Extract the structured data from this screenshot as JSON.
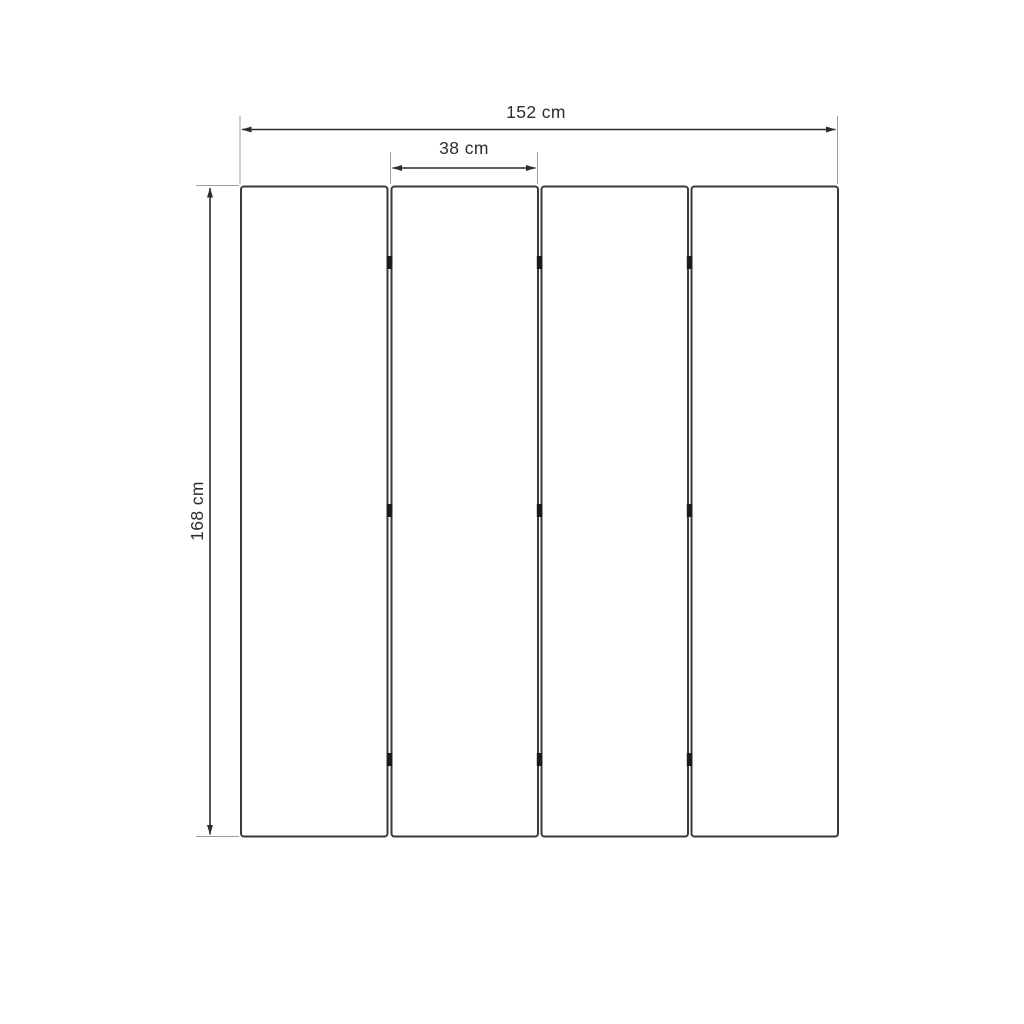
{
  "diagram": {
    "kind": "dimension-drawing",
    "subject": "four-panel folding screen, front view",
    "panel_count": 4,
    "hinge_rows": 3,
    "dimensions": {
      "total_width": {
        "label": "152 cm",
        "value_cm": 152
      },
      "panel_width": {
        "label": "38 cm",
        "value_cm": 38
      },
      "height": {
        "label": "168 cm",
        "value_cm": 168
      }
    },
    "colors": {
      "background": "#ffffff",
      "panel_outline": "#3a3a3a",
      "dimension_line": "#2d2d2d",
      "extension_line": "#9e9e9e",
      "hinge": "#1b1b1b",
      "text": "#2d2d2d"
    }
  }
}
